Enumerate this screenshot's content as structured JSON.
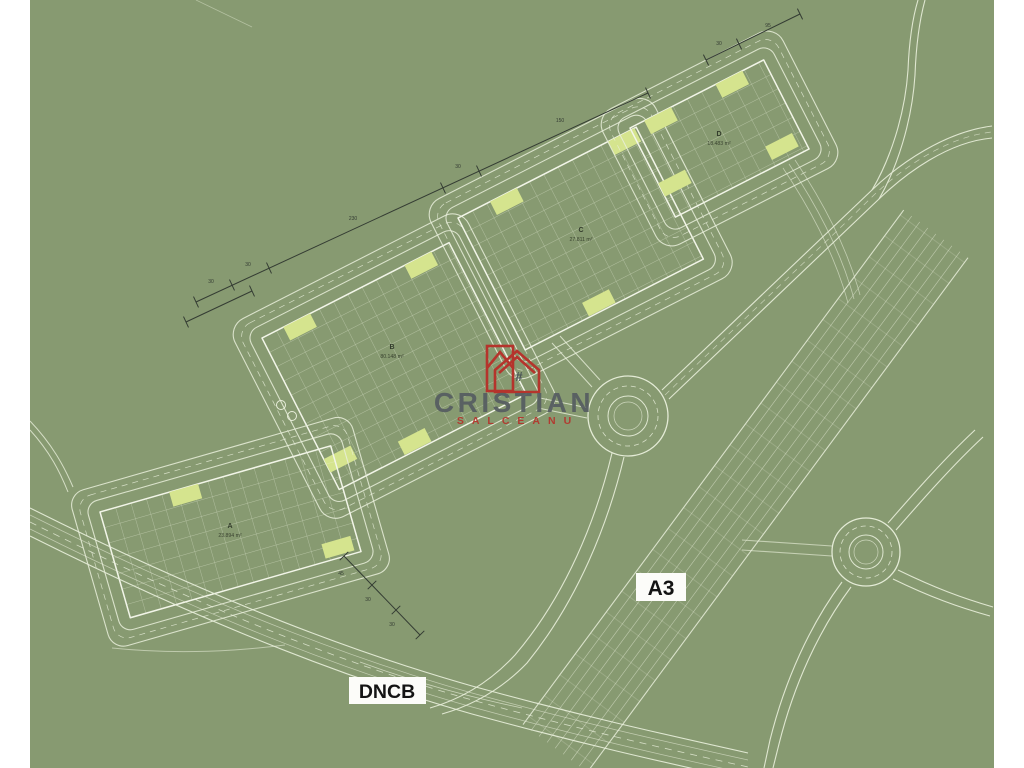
{
  "image": {
    "type": "cadastral-site-plan",
    "background_color": "#879a71",
    "frame_color": "#ffffff",
    "line_color": "#e9efdb",
    "highlight_color": "#d5e48e",
    "dimension_color": "#343c33"
  },
  "watermark": {
    "brand": "CRISTIAN",
    "subtitle": "SALCEANU",
    "hash_symbol": "#",
    "brand_color": "#575e61",
    "accent_color": "#b5342c"
  },
  "road_labels": {
    "highway": "A3",
    "national_road": "DNCB"
  },
  "plots": [
    {
      "id": "A",
      "area": "23.894 m²"
    },
    {
      "id": "B",
      "area": "80.148 m²"
    },
    {
      "id": "C",
      "area": "27.811 m²"
    },
    {
      "id": "D",
      "area": "18.483 m²"
    }
  ],
  "dimension_labels": {
    "c1": [
      "30",
      "30",
      "230",
      "30",
      "150"
    ],
    "c2": [
      "30",
      "95"
    ],
    "c3": [
      "45",
      "30",
      "30"
    ]
  }
}
